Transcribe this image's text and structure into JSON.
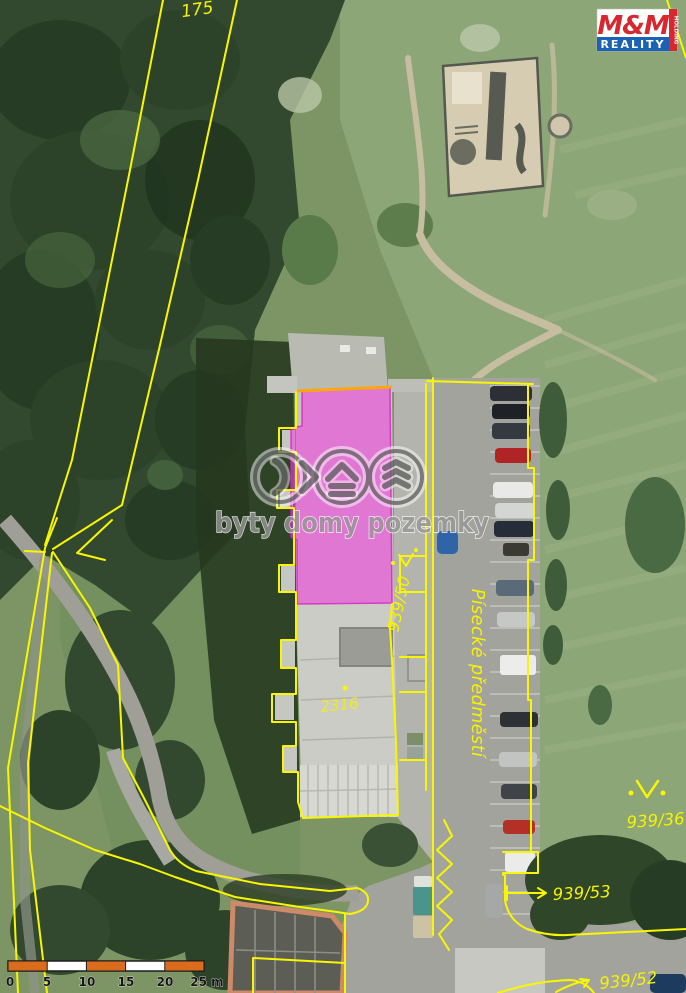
{
  "map": {
    "labels": {
      "parcel_forest": "175",
      "building_number": "2316",
      "parcel_road": "939/50",
      "street_name": "Písecké předměstí",
      "parcel_meadow": "939/36",
      "parcel_53": "939/53",
      "parcel_52": "939/52"
    },
    "colors": {
      "highlight_fill": "#f145e0",
      "parcel_line": "#f8f700"
    }
  },
  "watermark": {
    "text": "byty domy pozemky"
  },
  "logo": {
    "title": "M&M",
    "subtitle": "REALITY",
    "side_text": "HOLDING",
    "red": "#d7282f",
    "blue": "#1b61b5"
  },
  "scale_bar": {
    "ticks": [
      "0",
      "5",
      "10",
      "15",
      "20",
      "25 m"
    ],
    "bar_orange": "#db6c1e"
  }
}
